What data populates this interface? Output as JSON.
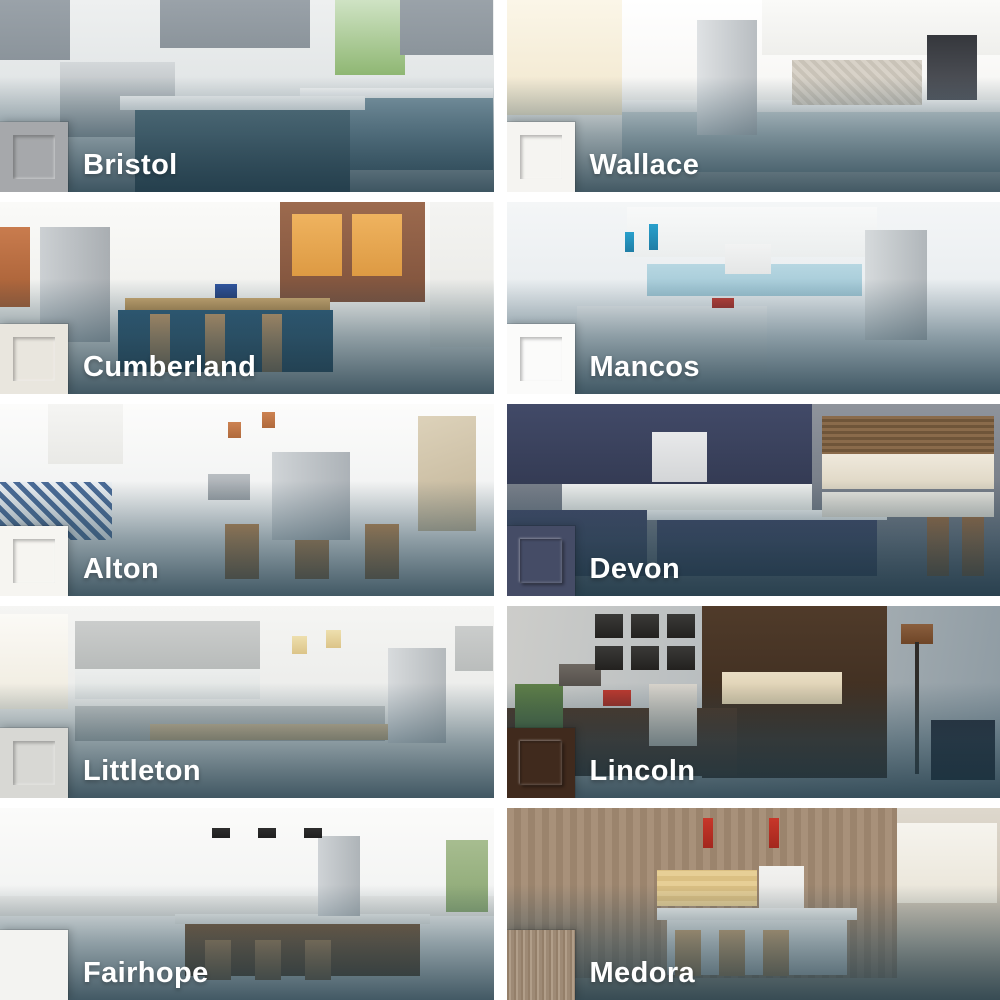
{
  "grid": {
    "overlay_color": "#2c4a59",
    "label_text_color": "#ffffff",
    "tiles": [
      {
        "name": "Bristol",
        "swatch_color": "#a6a8ab",
        "swatch_style": "shaker"
      },
      {
        "name": "Wallace",
        "swatch_color": "#f5f4f1",
        "swatch_style": "shaker"
      },
      {
        "name": "Cumberland",
        "swatch_color": "#e9e6de",
        "swatch_style": "shaker"
      },
      {
        "name": "Mancos",
        "swatch_color": "#fbfbfa",
        "swatch_style": "shaker"
      },
      {
        "name": "Alton",
        "swatch_color": "#f6f5f1",
        "swatch_style": "shaker"
      },
      {
        "name": "Devon",
        "swatch_color": "#454c66",
        "swatch_style": "raised-panel"
      },
      {
        "name": "Littleton",
        "swatch_color": "#d8d8d4",
        "swatch_style": "shaker"
      },
      {
        "name": "Lincoln",
        "swatch_color": "#402a1d",
        "swatch_style": "raised-panel"
      },
      {
        "name": "Fairhope",
        "swatch_color": "#f3f3f1",
        "swatch_style": "slab"
      },
      {
        "name": "Medora",
        "swatch_color": "#a8937c",
        "swatch_style": "wood-slab"
      }
    ]
  }
}
